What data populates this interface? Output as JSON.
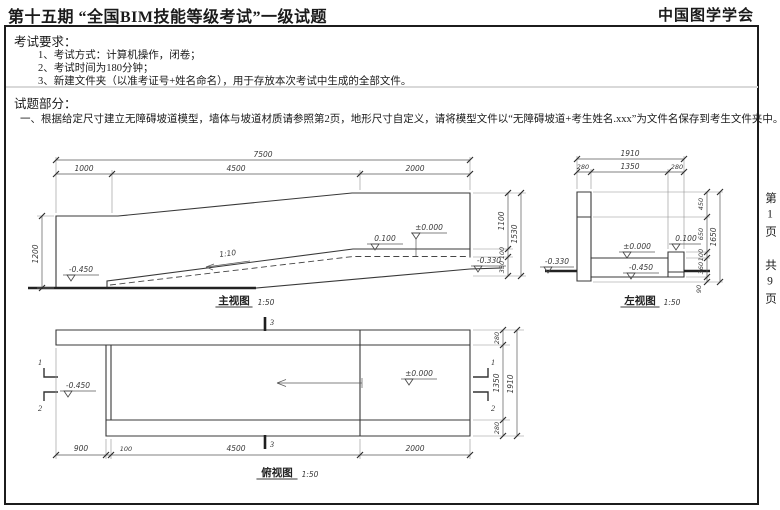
{
  "header": {
    "title": "第十五期 “全国BIM技能等级考试”一级试题",
    "org": "中国图学学会"
  },
  "requirements": {
    "heading": "考试要求：",
    "items": [
      "1、考试方式：计算机操作，闭卷；",
      "2、考试时间为180分钟；",
      "3、新建文件夹（以准考证号+姓名命名），用于存放本次考试中生成的全部文件。"
    ]
  },
  "question": {
    "heading": "试题部分：",
    "text": "一、根据给定尺寸建立无障碍坡道模型，墙体与坡道材质请参照第2页，地形尺寸自定义，请将模型文件以“无障碍坡道+考生姓名.xxx”为文件名保存到考生文件夹中。（15分）"
  },
  "page_margin": {
    "page": "第1页",
    "total": "共9页"
  },
  "front_view": {
    "title": "主视图",
    "scale": "1:50",
    "dim_total": "7500",
    "dim_1": "1000",
    "dim_2": "4500",
    "dim_3": "2000",
    "dim_left": "1200",
    "dim_r1": "1100",
    "dim_r2": "100",
    "dim_r3": "330",
    "dim_r_total": "1530",
    "level_left": "-0.450",
    "slope": "1:10",
    "level_mid": "0.100",
    "level_zero": "±0.000",
    "level_right": "-0.330"
  },
  "side_view": {
    "title": "左视图",
    "scale": "1:50",
    "dim_total": "1910",
    "dim_1": "280",
    "dim_2": "1350",
    "dim_3": "280",
    "dim_r1": "450",
    "dim_r2": "650",
    "dim_r3": "100",
    "dim_r4": "360",
    "dim_r5": "90",
    "dim_r_total": "1650",
    "level_zero": "±0.000",
    "level_curb": "0.100",
    "level_low": "-0.450",
    "level_ground": "-0.330"
  },
  "top_view": {
    "title": "俯视图",
    "scale": "1:50",
    "dim_1": "900",
    "dim_2": "100",
    "dim_3": "4500",
    "dim_4": "2000",
    "dim_r1": "280",
    "dim_r2": "1350",
    "dim_r3": "280",
    "dim_r_total": "1910",
    "level_left": "-0.450",
    "level_zero": "±0.000",
    "section_1": "1",
    "section_2": "2",
    "section_3": "3"
  }
}
